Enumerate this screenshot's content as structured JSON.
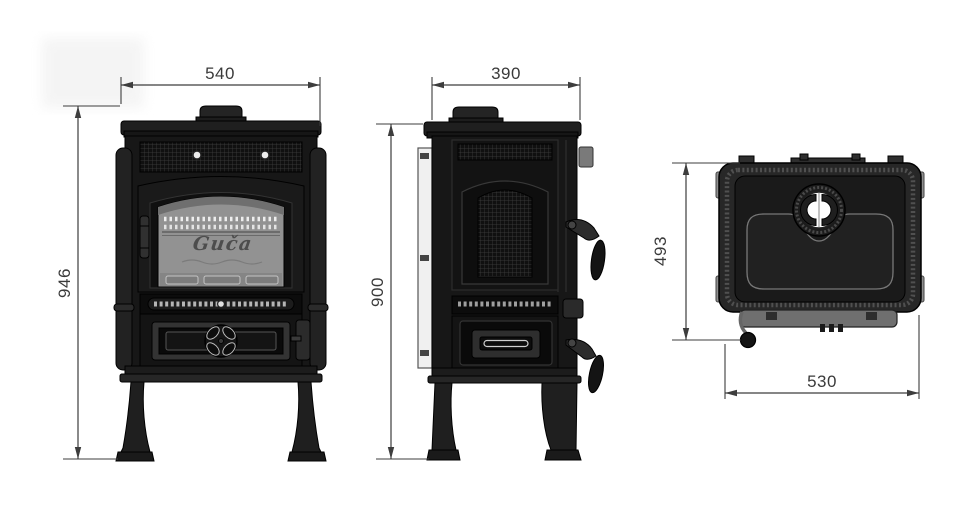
{
  "drawing": {
    "description": "stove dimensional drawing",
    "brand": {
      "logo": "Guča"
    },
    "views": {
      "front": {
        "width_label": "540",
        "height_label": "946"
      },
      "side": {
        "width_label": "390",
        "height_label": "900"
      },
      "top": {
        "width_label": "530",
        "depth_label": "493"
      }
    },
    "colors": {
      "line": "#3d3d3d",
      "stove_body": "#171717",
      "glass": "#949494",
      "background": "#ffffff"
    }
  }
}
